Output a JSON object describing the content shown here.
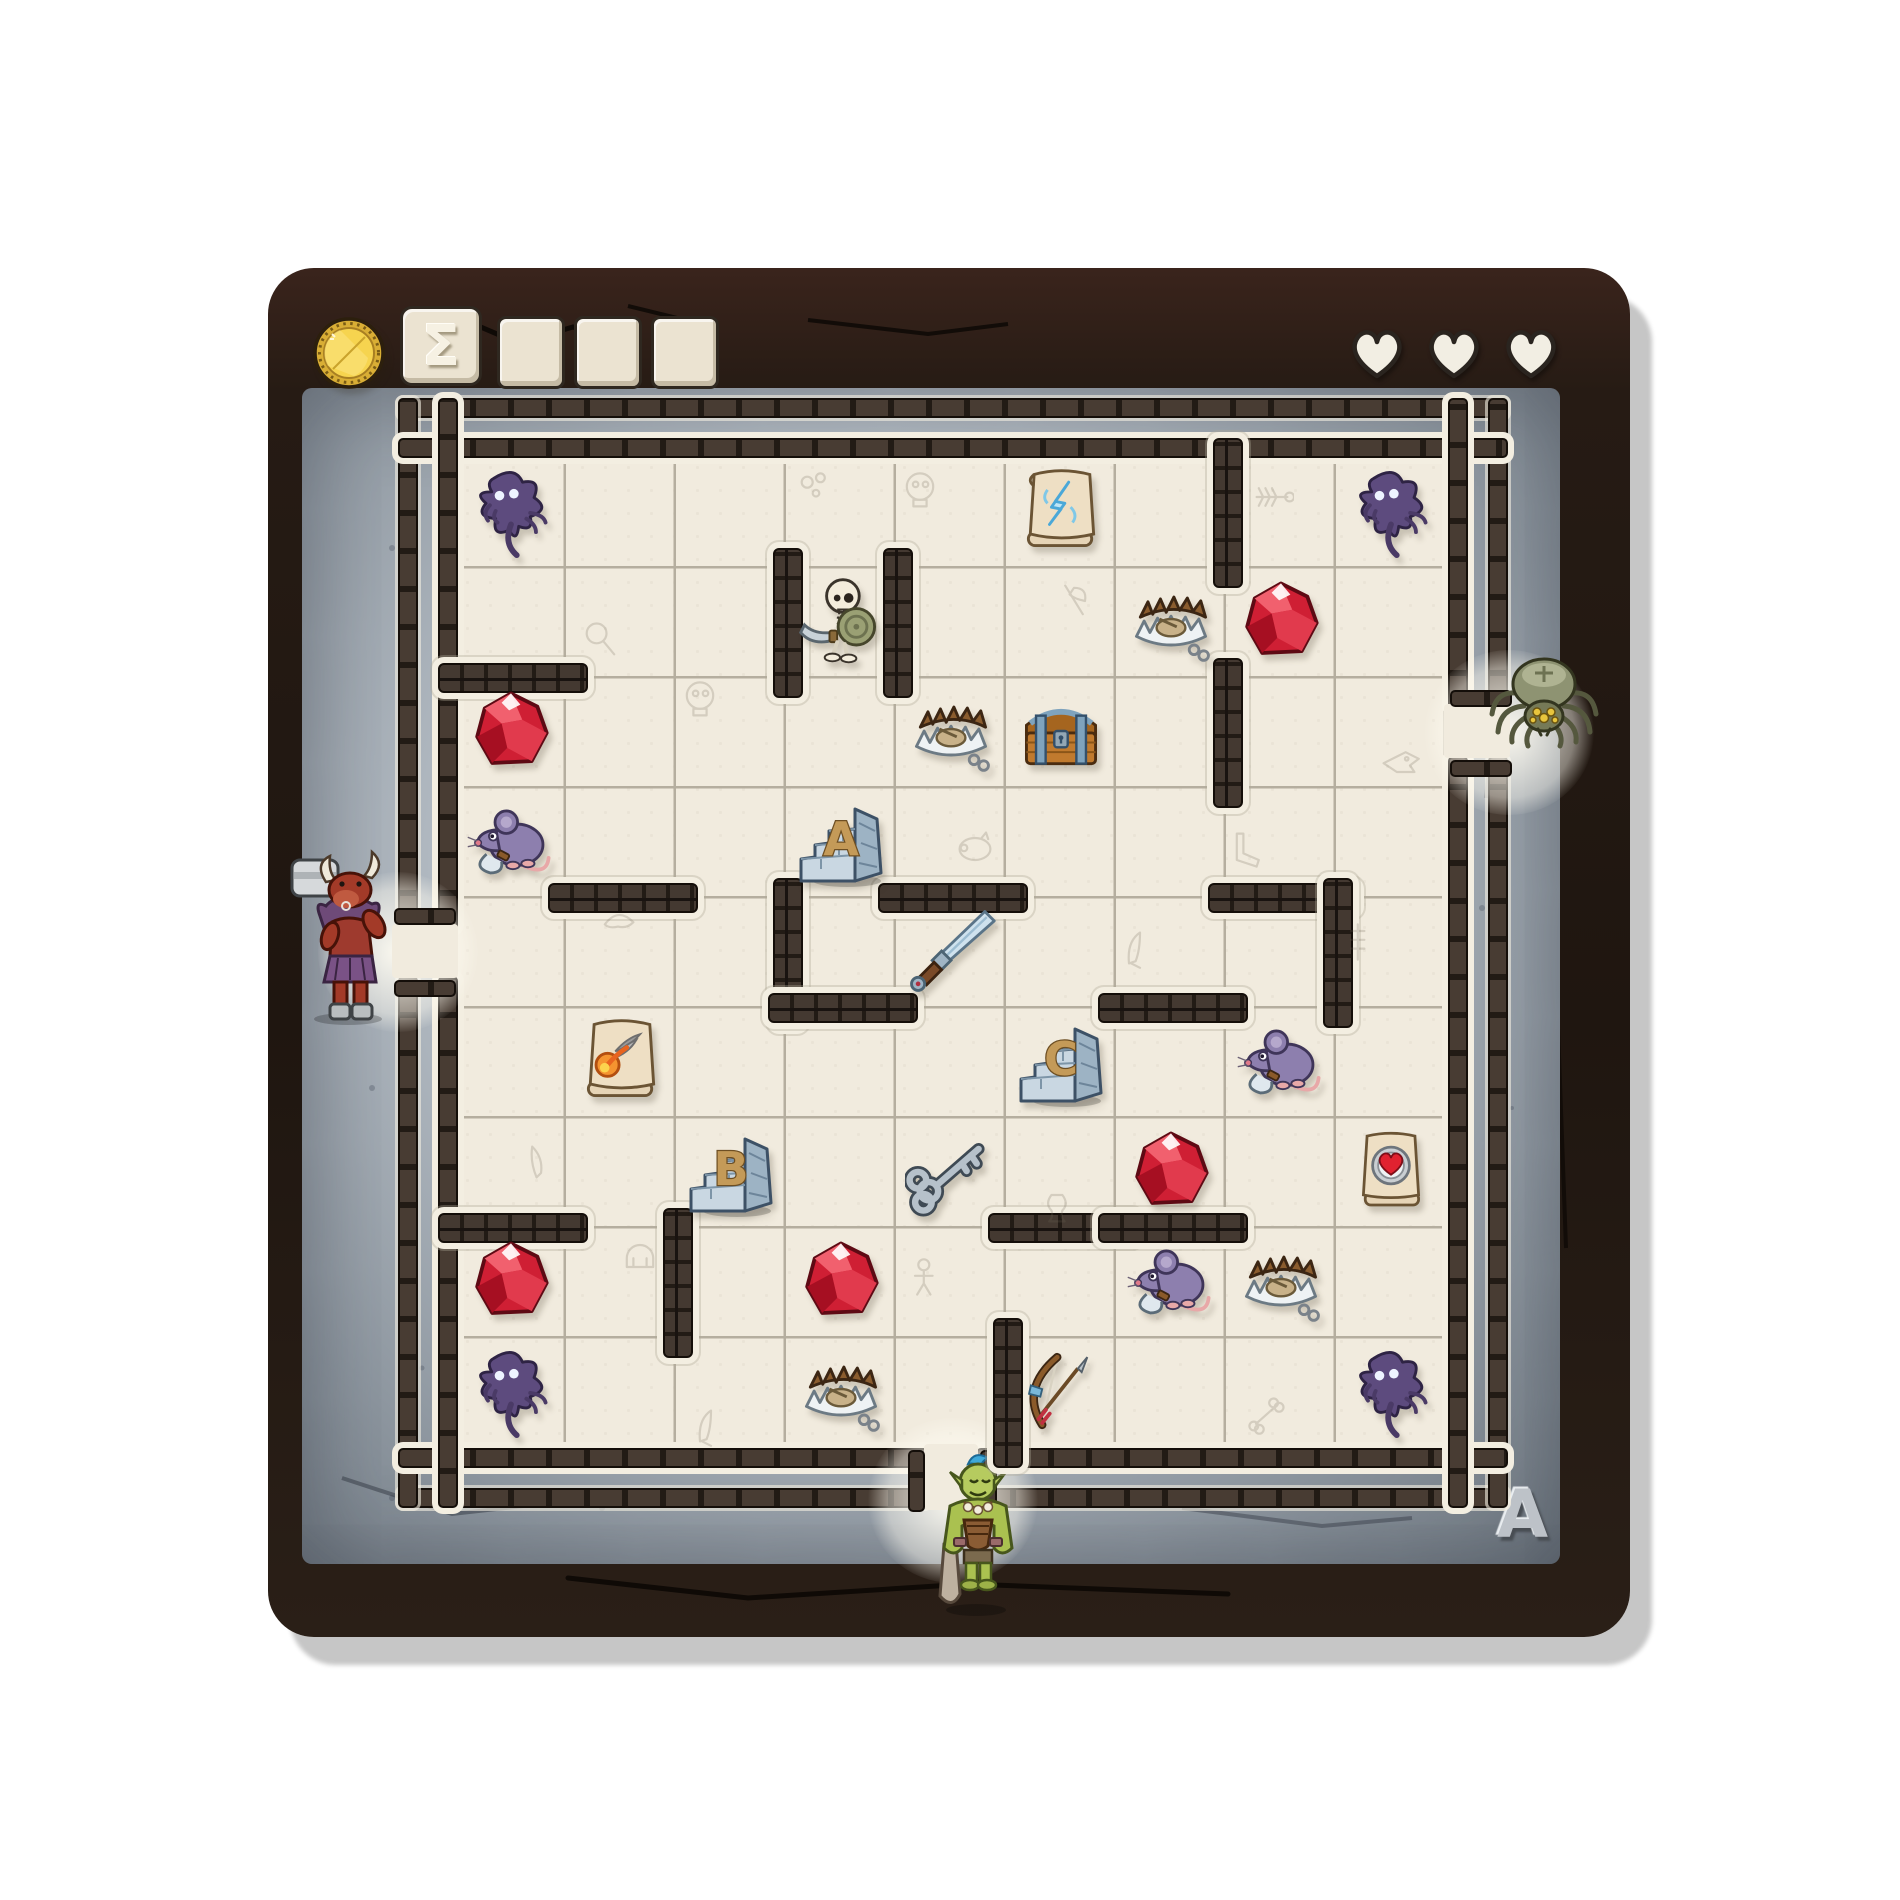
{
  "hud": {
    "coin": {
      "icon": "gold-coin-icon",
      "color": "#f6d44f"
    },
    "sigma_label": "Σ",
    "blank_tile_count": 3,
    "hearts": {
      "count": 3,
      "fill": "#f2eee3"
    }
  },
  "board": {
    "corner_label": "A",
    "grid": {
      "cols": 9,
      "rows": 9
    },
    "colors": {
      "frame": "#241b15",
      "stone_light": "#ccd3d9",
      "stone_dark": "#6f7881",
      "floor": "#f1ebde",
      "grid_line": "#b5ae9f",
      "brick": "#483c33",
      "brick_dark": "#221b15",
      "mortar": "#f3eee1",
      "gem_red": "#d6263a",
      "letter_gold": "#c49a58",
      "block_stone": "#c9d7e2",
      "shadow_purple": "#5d4b7e",
      "mouse_purple": "#8d7fae",
      "orc_green": "#b6cb5f",
      "minotaur_red": "#9e3a2e",
      "spider_olive": "#8e9372"
    }
  },
  "entrances": [
    {
      "side": "left",
      "row": 5,
      "monster": "minotaur"
    },
    {
      "side": "right",
      "row": 3,
      "monster": "spider"
    },
    {
      "side": "bottom",
      "col": 5,
      "monster": "orc"
    }
  ],
  "walls": [
    {
      "o": "v",
      "col": 3,
      "row": 2
    },
    {
      "o": "v",
      "col": 4,
      "row": 2
    },
    {
      "o": "v",
      "col": 7,
      "row": 1
    },
    {
      "o": "v",
      "col": 7,
      "row": 3
    },
    {
      "o": "h",
      "col": 1,
      "row": 2
    },
    {
      "o": "h",
      "col": 2,
      "row": 4
    },
    {
      "o": "h",
      "col": 5,
      "row": 4
    },
    {
      "o": "h",
      "col": 8,
      "row": 4
    },
    {
      "o": "v",
      "col": 3,
      "row": 5
    },
    {
      "o": "h",
      "col": 4,
      "row": 5
    },
    {
      "o": "h",
      "col": 7,
      "row": 5
    },
    {
      "o": "v",
      "col": 8,
      "row": 5
    },
    {
      "o": "h",
      "col": 1,
      "row": 7
    },
    {
      "o": "h",
      "col": 6,
      "row": 7
    },
    {
      "o": "h",
      "col": 7,
      "row": 7
    },
    {
      "o": "v",
      "col": 2,
      "row": 8
    },
    {
      "o": "v",
      "col": 5,
      "row": 9
    }
  ],
  "items": [
    {
      "type": "shadow",
      "col": 1,
      "row": 1
    },
    {
      "type": "shadow",
      "col": 9,
      "row": 1
    },
    {
      "type": "shadow",
      "col": 1,
      "row": 9
    },
    {
      "type": "shadow",
      "col": 9,
      "row": 9
    },
    {
      "type": "scroll_lightning",
      "col": 6,
      "row": 1
    },
    {
      "type": "skeleton",
      "col": 4,
      "row": 2
    },
    {
      "type": "trap",
      "col": 7,
      "row": 2
    },
    {
      "type": "trap",
      "col": 5,
      "row": 3
    },
    {
      "type": "trap",
      "col": 8,
      "row": 8
    },
    {
      "type": "trap",
      "col": 4,
      "row": 9
    },
    {
      "type": "gem",
      "col": 8,
      "row": 2
    },
    {
      "type": "gem",
      "col": 1,
      "row": 3
    },
    {
      "type": "gem",
      "col": 7,
      "row": 7
    },
    {
      "type": "gem",
      "col": 1,
      "row": 8
    },
    {
      "type": "gem",
      "col": 4,
      "row": 8
    },
    {
      "type": "chest",
      "col": 6,
      "row": 3
    },
    {
      "type": "mouse",
      "col": 1,
      "row": 4
    },
    {
      "type": "mouse",
      "col": 8,
      "row": 6
    },
    {
      "type": "mouse",
      "col": 7,
      "row": 8
    },
    {
      "type": "block",
      "label": "A",
      "col": 4,
      "row": 4
    },
    {
      "type": "block",
      "label": "B",
      "col": 3,
      "row": 7
    },
    {
      "type": "block",
      "label": "C",
      "col": 6,
      "row": 6
    },
    {
      "type": "sword",
      "col": 5,
      "row": 5
    },
    {
      "type": "scroll_fireball",
      "col": 2,
      "row": 6
    },
    {
      "type": "key",
      "col": 5,
      "row": 7
    },
    {
      "type": "scroll_heart",
      "col": 9,
      "row": 7
    },
    {
      "type": "bow",
      "col": 6,
      "row": 9
    }
  ],
  "doodles": [
    {
      "type": "bubbles",
      "col": 4,
      "row": 1,
      "ox": 0.25,
      "oy": 0.3
    },
    {
      "type": "skull",
      "col": 5,
      "row": 1,
      "ox": 0.2,
      "oy": 0.3
    },
    {
      "type": "fishbone",
      "col": 8,
      "row": 1,
      "ox": 0.4,
      "oy": 0.35
    },
    {
      "type": "magnifier",
      "col": 2,
      "row": 2,
      "ox": 0.3,
      "oy": 0.65
    },
    {
      "type": "axe",
      "col": 6,
      "row": 2,
      "ox": 0.6,
      "oy": 0.3
    },
    {
      "type": "skull",
      "col": 3,
      "row": 3,
      "ox": 0.2,
      "oy": 0.2
    },
    {
      "type": "dragon",
      "col": 9,
      "row": 3,
      "ox": 0.55,
      "oy": 0.75
    },
    {
      "type": "pig",
      "col": 5,
      "row": 4,
      "ox": 0.7,
      "oy": 0.55
    },
    {
      "type": "boot",
      "col": 8,
      "row": 4,
      "ox": 0.2,
      "oy": 0.55
    },
    {
      "type": "croissant",
      "col": 2,
      "row": 5,
      "ox": 0.45,
      "oy": 0.2
    },
    {
      "type": "blade",
      "col": 7,
      "row": 5,
      "ox": 0.2,
      "oy": 0.45
    },
    {
      "type": "spine",
      "col": 9,
      "row": 5,
      "ox": 0.2,
      "oy": 0.4
    },
    {
      "type": "knife",
      "col": 1,
      "row": 7,
      "ox": 0.75,
      "oy": 0.4
    },
    {
      "type": "vase",
      "col": 6,
      "row": 7,
      "ox": 0.45,
      "oy": 0.8
    },
    {
      "type": "helmet",
      "col": 2,
      "row": 8,
      "ox": 0.65,
      "oy": 0.25
    },
    {
      "type": "figure",
      "col": 5,
      "row": 8,
      "ox": 0.25,
      "oy": 0.45
    },
    {
      "type": "blade",
      "col": 3,
      "row": 9,
      "ox": 0.3,
      "oy": 0.8
    },
    {
      "type": "bone",
      "col": 8,
      "row": 9,
      "ox": 0.35,
      "oy": 0.7
    }
  ]
}
